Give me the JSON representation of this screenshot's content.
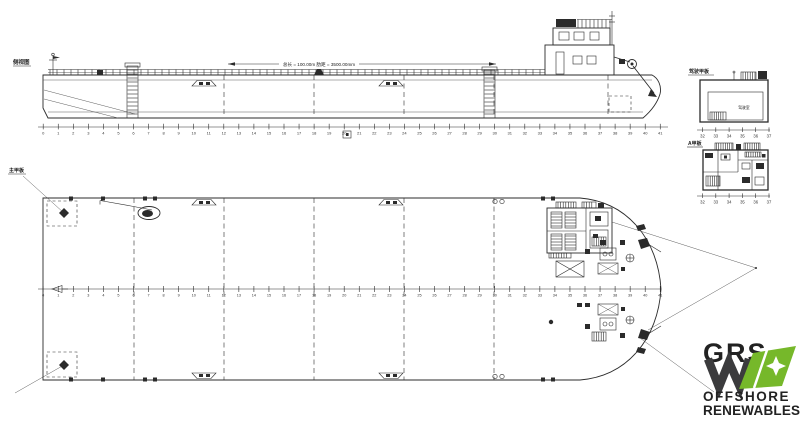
{
  "labels": {
    "profile_view": "侧视图",
    "plan_view": "主甲板",
    "bridge_deck_view": "驾驶甲板",
    "a_deck_view": "A甲板",
    "bridge_room": "驾驶室",
    "dimension_note": "总长 = 100.00m  肋距 = 3500.00mm"
  },
  "rulers": {
    "main_frames": [
      0,
      1,
      2,
      3,
      4,
      5,
      6,
      7,
      8,
      9,
      10,
      11,
      12,
      13,
      14,
      15,
      16,
      17,
      18,
      19,
      20,
      21,
      22,
      23,
      24,
      25,
      26,
      27,
      28,
      29,
      30,
      31,
      32,
      33,
      34,
      35,
      36,
      37,
      38,
      39,
      40,
      41
    ],
    "house_frames": [
      32,
      33,
      34,
      35,
      36,
      37
    ]
  },
  "logo": {
    "name": "GRS",
    "line2": "OFFSHORE",
    "line3": "RENEWABLES",
    "green": "#76b82a",
    "dark": "#3b3b3d",
    "white": "#ffffff"
  },
  "colors": {
    "background": "#ffffff",
    "line": "#2b2b2b"
  }
}
